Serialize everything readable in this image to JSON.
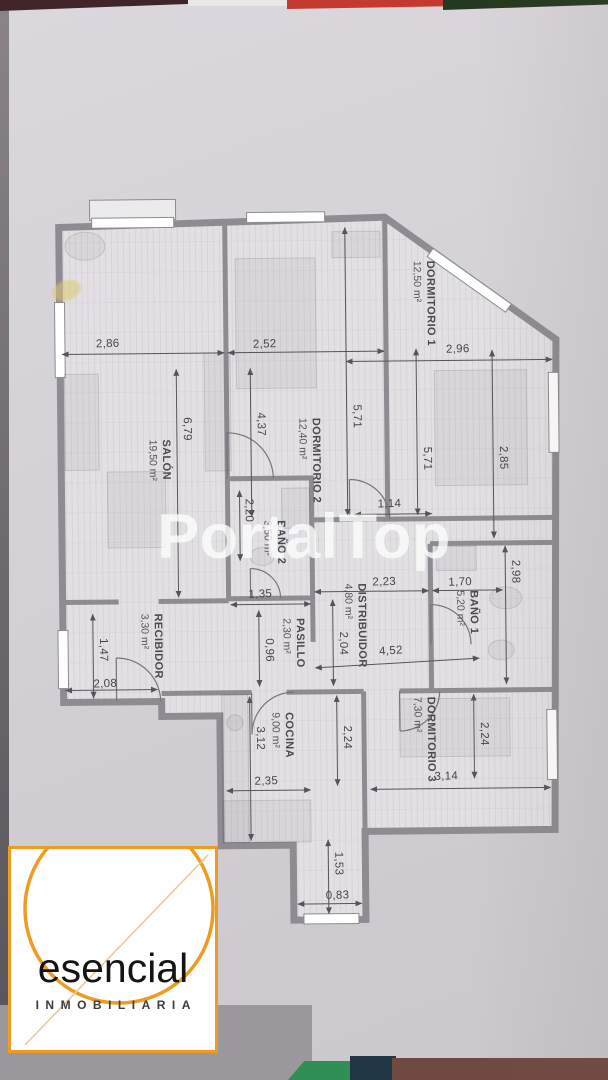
{
  "watermark": "PortalTop",
  "logo": {
    "name": "esencial",
    "tagline": "INMOBILIARIA",
    "accent_color": "#ED9C21"
  },
  "colors": {
    "wall": "#8E8B92",
    "paper": "#D4D1D6",
    "dimension_text": "#46444C"
  },
  "plan": {
    "rooms": [
      {
        "name": "SALÓN",
        "area": "19,50 m²"
      },
      {
        "name": "DORMITORIO 1",
        "area": "12,50 m²"
      },
      {
        "name": "DORMITORIO 2",
        "area": "12,40 m²"
      },
      {
        "name": "BAÑO 2",
        "area": "3,50 m²"
      },
      {
        "name": "DISTRIBUIDOR",
        "area": "4,80 m²"
      },
      {
        "name": "PASILLO",
        "area": "2,30 m²"
      },
      {
        "name": "RECIBIDOR",
        "area": "3,30 m²"
      },
      {
        "name": "BAÑO 1",
        "area": "5,20 m²"
      },
      {
        "name": "COCINA",
        "area": "9,00 m²"
      },
      {
        "name": "DORMITORIO 3",
        "area": "7,30 m²"
      }
    ],
    "dimensions": {
      "top_left": "2,86",
      "top_mid": "2,52",
      "top_right": "2,96",
      "salon_h": "6,79",
      "dorm2_left_h": "4,37",
      "dorm2_h": "5,71",
      "dorm1_h": "5,71",
      "dorm1_w": "2,85",
      "hall_small": "1,14",
      "bano2_h": "2,20",
      "bano2_w": "1,35",
      "bano1_top": "2,98",
      "dist_top": "2,23",
      "bano1_w": "1,70",
      "dist_diag": "4,52",
      "pasillo_v": "2,04",
      "pasillo_w": "0,96",
      "recibidor_v": "1,47",
      "recibidor_w": "2,08",
      "cocina_v": "3,12",
      "cocina_v2": "2,24",
      "cocina_w": "2,35",
      "dorm3_v": "2,24",
      "dorm3_w": "3,14",
      "terrace_v": "1,53",
      "terrace_w": "0,83"
    }
  }
}
